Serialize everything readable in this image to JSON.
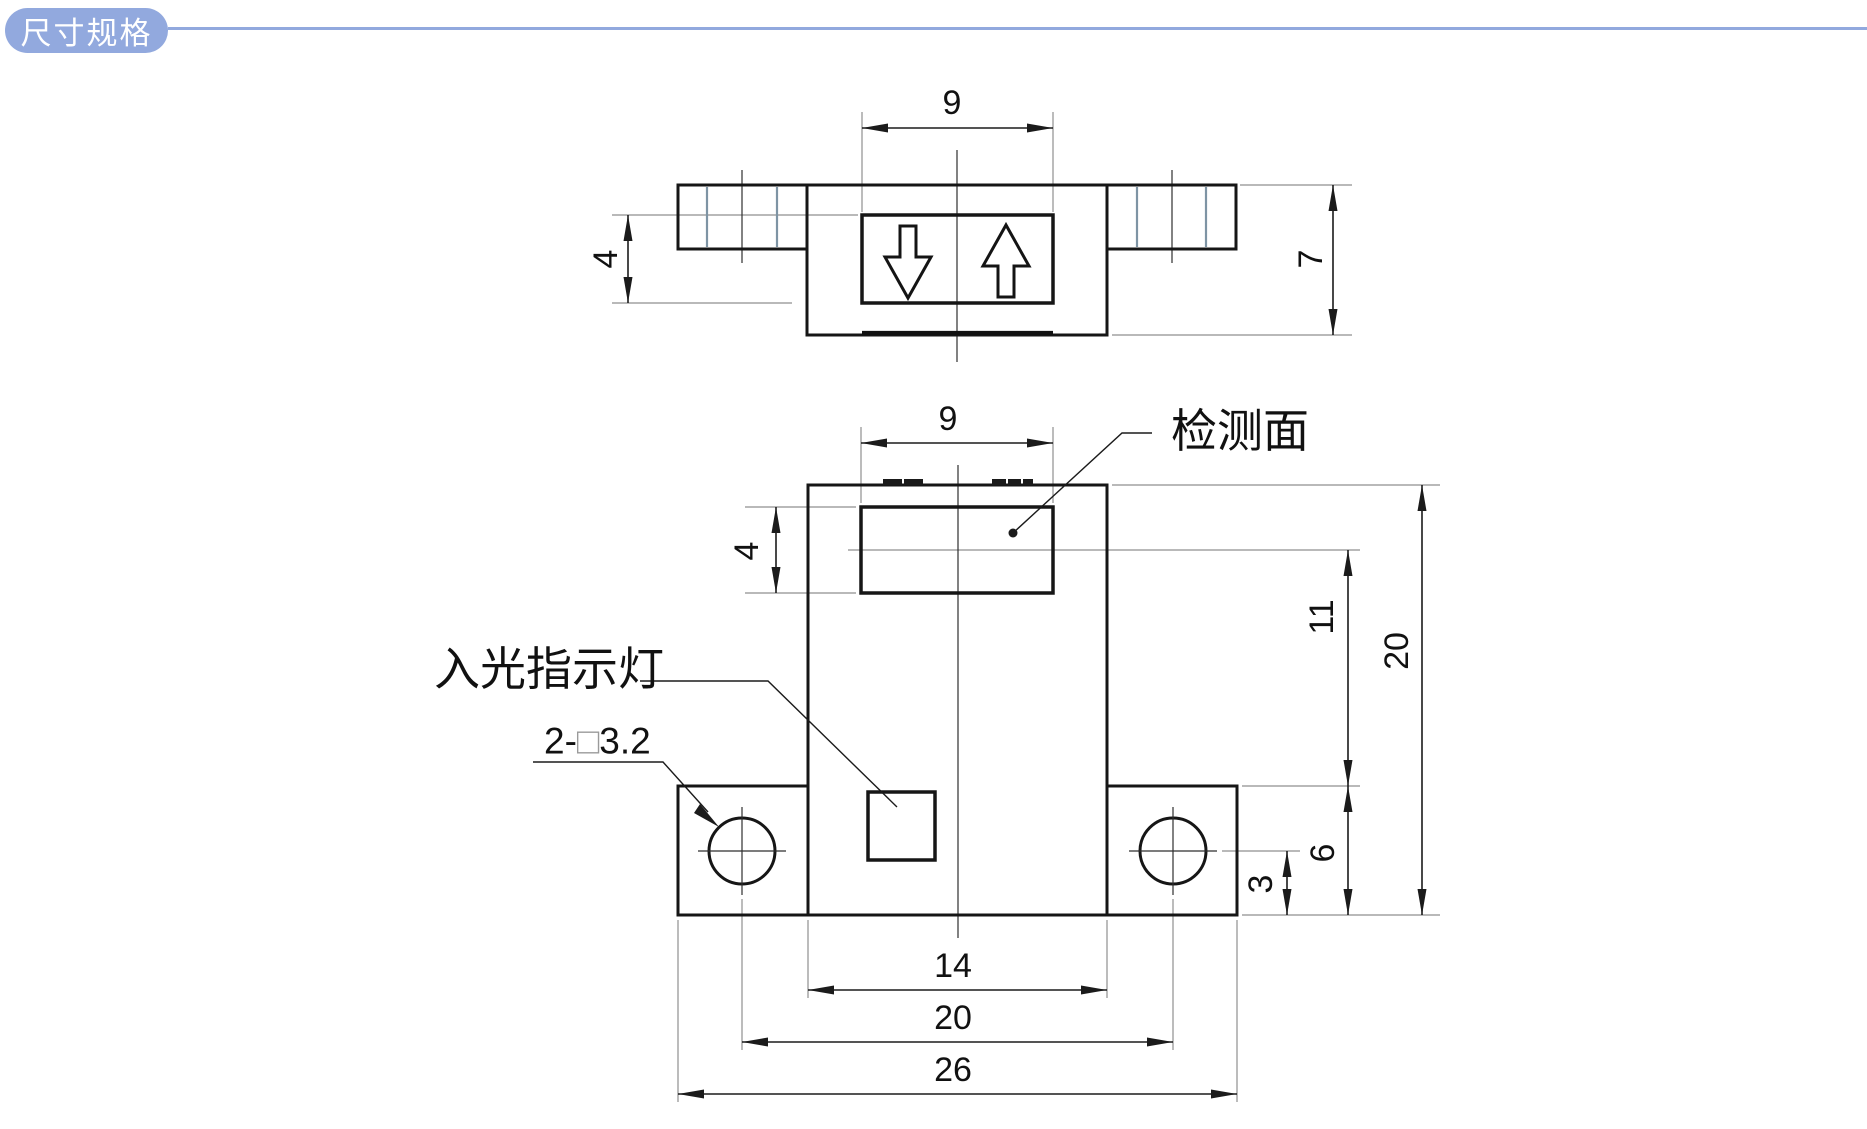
{
  "header": {
    "badge_label": "尺寸规格"
  },
  "top_view": {
    "dim_window_width": "9",
    "dim_window_height": "4",
    "dim_body_height": "7"
  },
  "front_view": {
    "dim_window_width": "9",
    "dim_window_height": "4",
    "dim_axis_to_flange_top": "11",
    "dim_overall_height": "20",
    "dim_flange_height": "6",
    "dim_hole_to_bottom": "3",
    "dim_body_width": "14",
    "dim_hole_spacing": "20",
    "dim_overall_width": "26",
    "label_detection_face": "检测面",
    "label_light_indicator": "入光指示灯",
    "label_mount_holes_prefix": "2-",
    "label_mount_holes_box": "□",
    "label_mount_holes_suffix": "3.2"
  },
  "colors": {
    "accent": "#92A9DE",
    "outline": "#161616",
    "wing_hatch": "#7E94A4",
    "extension_line": "#8f8f8f"
  }
}
